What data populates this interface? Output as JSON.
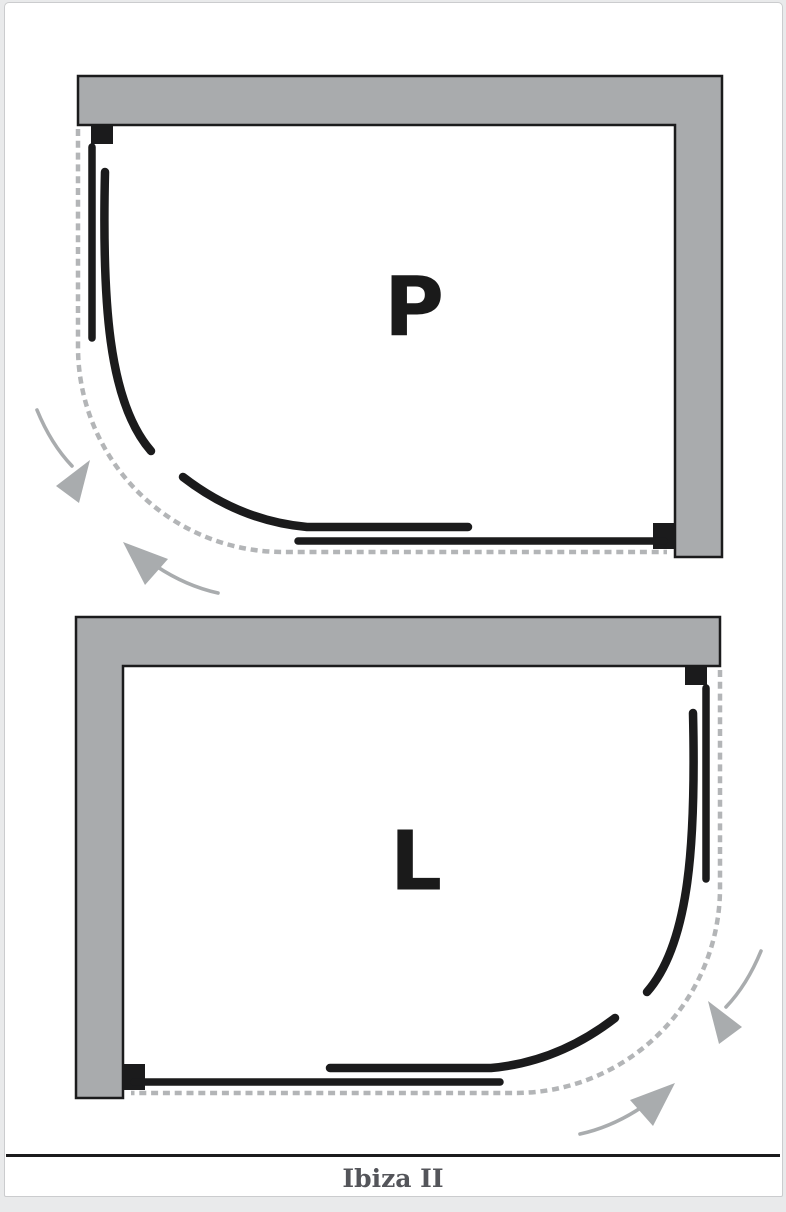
{
  "diagrams": [
    {
      "label": "P",
      "orientation": "corner top-right, curved entry bottom-left",
      "icons": [
        "curved-arrow-icon",
        "curved-arrow-icon"
      ]
    },
    {
      "label": "L",
      "orientation": "corner top-left, curved entry bottom-right",
      "icons": [
        "curved-arrow-icon",
        "curved-arrow-icon"
      ]
    }
  ],
  "caption": {
    "text": "Ibiza II"
  },
  "colors": {
    "bg": "#e9eaeb",
    "surface": "#ffffff",
    "frame": "#cbccce",
    "ink": "#1b1b1c",
    "wall": "#a9abad",
    "dash": "#b3b5b7",
    "arrow": "#a9acae",
    "label": "#1a1a1a",
    "caption": "#54555a"
  }
}
